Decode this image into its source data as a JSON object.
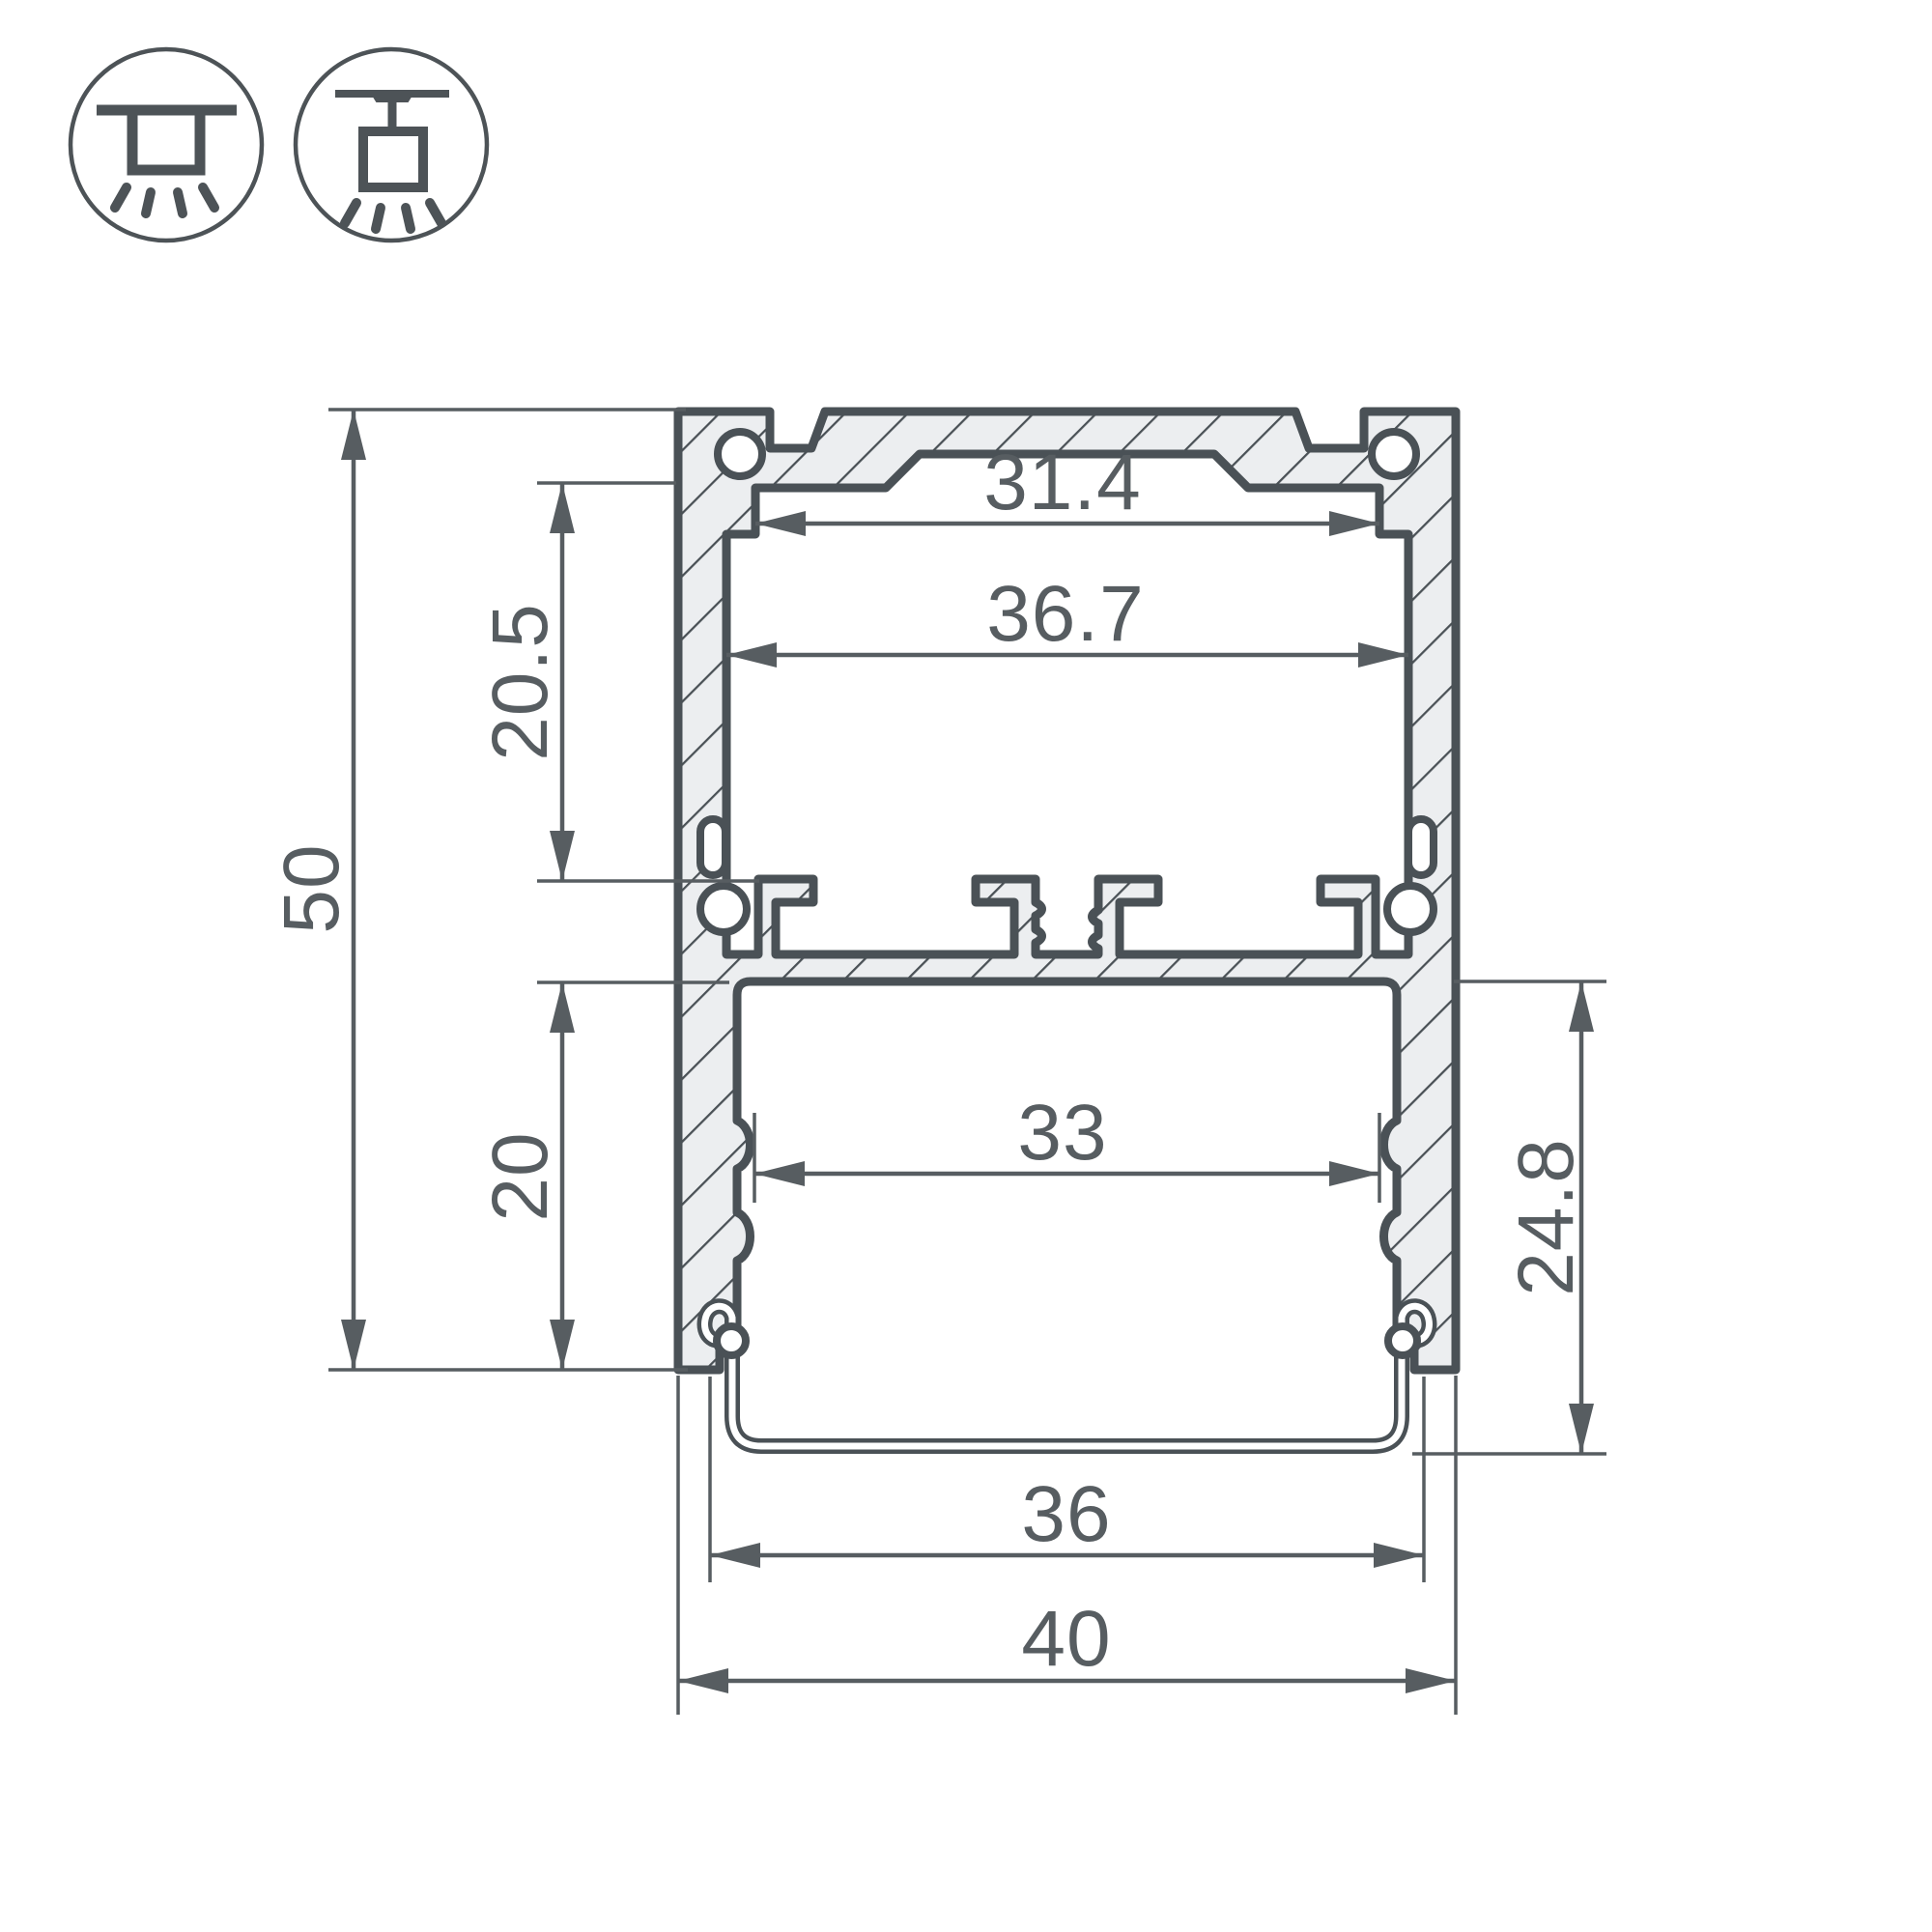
{
  "palette": {
    "outline": "#4a5156",
    "dimension_lines": "#575d61",
    "aluminum_fill": "#eceef0",
    "background": "#ffffff"
  },
  "icons": {
    "surface": {
      "name": "surface-mount-icon",
      "meaning": "surface ceiling mounting of luminaire"
    },
    "pendant": {
      "name": "pendant-mount-icon",
      "meaning": "suspended (pendant) mounting of luminaire"
    }
  },
  "dimensions": {
    "units": "mm",
    "overall_height": "50",
    "overall_width": "40",
    "top_opening": "31.4",
    "upper_chamber_width": "36.7",
    "upper_chamber_height": "20.5",
    "lower_chamber_height": "20",
    "led_platform_width": "33",
    "diffuser_section_height": "24.8",
    "diffuser_width": "36"
  }
}
